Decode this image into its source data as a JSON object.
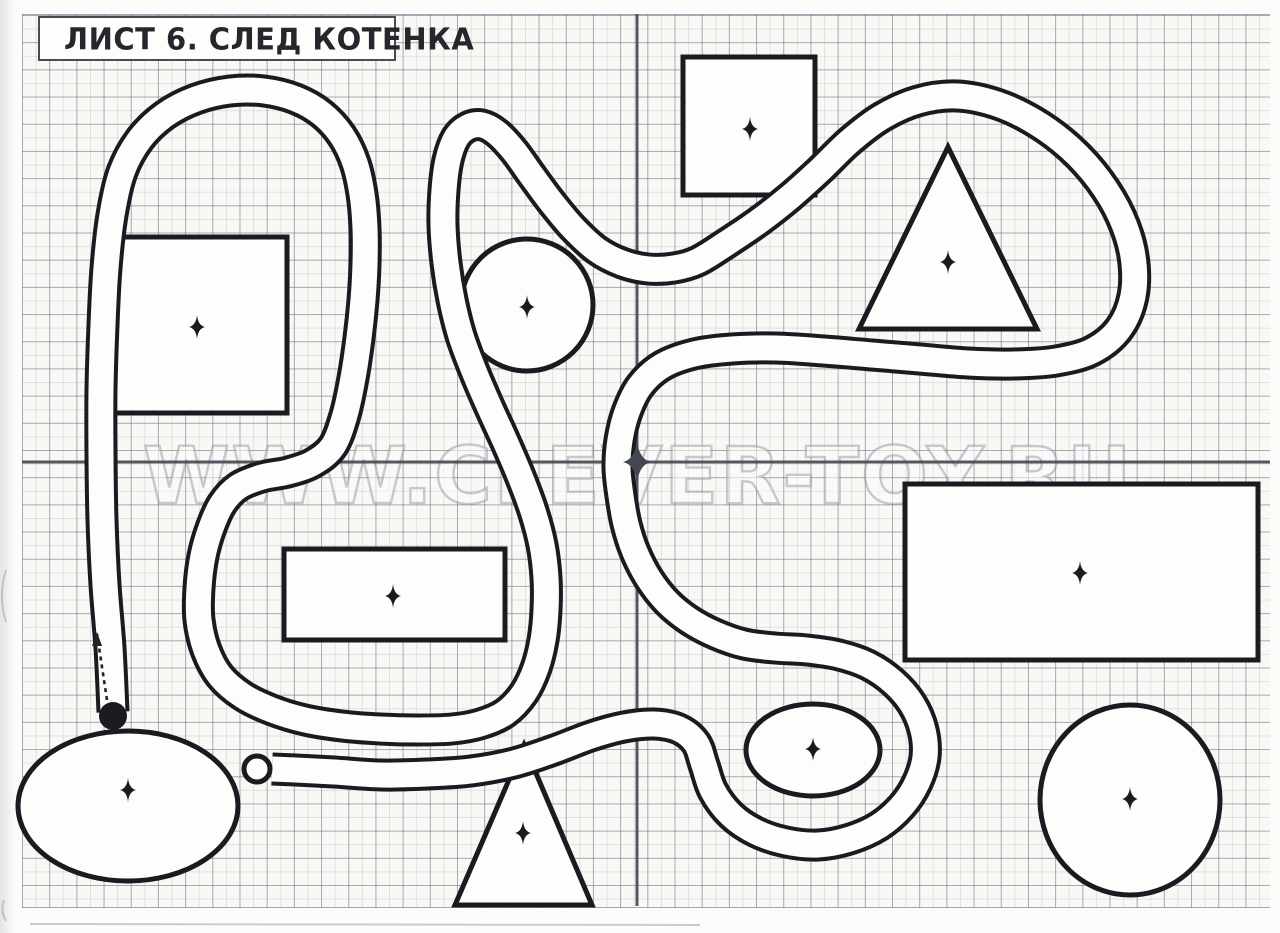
{
  "page": {
    "title": "ЛИСТ 6. СЛЕД КОТЕНКА",
    "watermark": "WWW.CLEVER-TOY.RU",
    "paper_color": "#f8f8f5",
    "ink_color": "#1a1b20",
    "grid_color": "#6e7387",
    "fold_line_color": "#444752",
    "scan_marks": [
      "M6,570 Q-2,596 6,622",
      "M4,900 Q0,911 6,921",
      "M30,924 L700,925"
    ]
  },
  "maze": {
    "fold": {
      "vertical_x": 637,
      "horizontal_y": 462,
      "top": 14,
      "bottom": 906,
      "left": 22,
      "right": 1270
    },
    "center_star": {
      "x": 637,
      "y": 462,
      "sx": 14,
      "sy": 22
    },
    "road": {
      "width_outer": 33,
      "width_inner": 25
    },
    "road_points": [
      [
        113,
        712
      ],
      [
        110,
        648
      ],
      [
        105,
        585
      ],
      [
        102,
        520
      ],
      [
        101,
        455
      ],
      [
        101,
        390
      ],
      [
        103,
        325
      ],
      [
        106,
        268
      ],
      [
        112,
        215
      ],
      [
        122,
        172
      ],
      [
        140,
        139
      ],
      [
        165,
        115
      ],
      [
        196,
        99
      ],
      [
        230,
        91
      ],
      [
        264,
        91
      ],
      [
        296,
        99
      ],
      [
        322,
        114
      ],
      [
        342,
        136
      ],
      [
        355,
        163
      ],
      [
        362,
        194
      ],
      [
        365,
        228
      ],
      [
        365,
        264
      ],
      [
        363,
        300
      ],
      [
        359,
        338
      ],
      [
        353,
        378
      ],
      [
        345,
        415
      ],
      [
        333,
        446
      ],
      [
        313,
        463
      ],
      [
        288,
        472
      ],
      [
        262,
        477
      ],
      [
        238,
        487
      ],
      [
        222,
        504
      ],
      [
        211,
        528
      ],
      [
        203,
        556
      ],
      [
        199,
        588
      ],
      [
        199,
        620
      ],
      [
        206,
        650
      ],
      [
        220,
        676
      ],
      [
        243,
        696
      ],
      [
        272,
        710
      ],
      [
        305,
        720
      ],
      [
        342,
        726
      ],
      [
        380,
        729
      ],
      [
        418,
        730
      ],
      [
        452,
        729
      ],
      [
        480,
        724
      ],
      [
        505,
        713
      ],
      [
        524,
        693
      ],
      [
        536,
        668
      ],
      [
        543,
        640
      ],
      [
        546,
        610
      ],
      [
        546,
        578
      ],
      [
        542,
        545
      ],
      [
        533,
        511
      ],
      [
        520,
        476
      ],
      [
        505,
        441
      ],
      [
        489,
        406
      ],
      [
        474,
        371
      ],
      [
        461,
        336
      ],
      [
        452,
        300
      ],
      [
        446,
        263
      ],
      [
        443,
        225
      ],
      [
        444,
        190
      ],
      [
        448,
        160
      ],
      [
        456,
        138
      ],
      [
        468,
        127
      ],
      [
        482,
        125
      ],
      [
        497,
        133
      ],
      [
        514,
        151
      ],
      [
        532,
        176
      ],
      [
        552,
        203
      ],
      [
        573,
        228
      ],
      [
        597,
        250
      ],
      [
        622,
        263
      ],
      [
        648,
        269
      ],
      [
        674,
        268
      ],
      [
        698,
        261
      ],
      [
        727,
        243
      ],
      [
        758,
        222
      ],
      [
        790,
        197
      ],
      [
        820,
        170
      ],
      [
        850,
        141
      ],
      [
        882,
        117
      ],
      [
        918,
        101
      ],
      [
        957,
        96
      ],
      [
        997,
        104
      ],
      [
        1035,
        122
      ],
      [
        1070,
        148
      ],
      [
        1099,
        180
      ],
      [
        1121,
        217
      ],
      [
        1133,
        256
      ],
      [
        1133,
        296
      ],
      [
        1119,
        329
      ],
      [
        1092,
        351
      ],
      [
        1056,
        361
      ],
      [
        1014,
        364
      ],
      [
        968,
        363
      ],
      [
        920,
        359
      ],
      [
        872,
        355
      ],
      [
        824,
        351
      ],
      [
        776,
        348
      ],
      [
        732,
        349
      ],
      [
        694,
        354
      ],
      [
        662,
        366
      ],
      [
        640,
        386
      ],
      [
        627,
        412
      ],
      [
        620,
        440
      ],
      [
        618,
        468
      ],
      [
        621,
        496
      ],
      [
        626,
        524
      ],
      [
        635,
        552
      ],
      [
        649,
        579
      ],
      [
        667,
        602
      ],
      [
        689,
        620
      ],
      [
        715,
        634
      ],
      [
        744,
        644
      ],
      [
        775,
        648
      ],
      [
        807,
        650
      ],
      [
        839,
        655
      ],
      [
        868,
        665
      ],
      [
        893,
        682
      ],
      [
        912,
        704
      ],
      [
        923,
        730
      ],
      [
        925,
        757
      ],
      [
        917,
        783
      ],
      [
        902,
        806
      ],
      [
        879,
        826
      ],
      [
        850,
        839
      ],
      [
        818,
        845
      ],
      [
        786,
        842
      ],
      [
        756,
        832
      ],
      [
        731,
        815
      ],
      [
        713,
        791
      ],
      [
        704,
        765
      ],
      [
        696,
        743
      ],
      [
        679,
        729
      ],
      [
        654,
        724
      ],
      [
        624,
        727
      ],
      [
        591,
        736
      ],
      [
        554,
        750
      ],
      [
        514,
        763
      ],
      [
        471,
        771
      ],
      [
        427,
        774
      ],
      [
        381,
        775
      ],
      [
        334,
        772
      ],
      [
        296,
        770
      ],
      [
        272,
        769
      ]
    ],
    "start_marker": {
      "x": 113,
      "y": 716,
      "r": 14
    },
    "end_marker": {
      "x": 257,
      "y": 769,
      "r": 13
    },
    "arrow": {
      "x1": 107,
      "y1": 700,
      "x2": 97,
      "y2": 634
    },
    "shapes": [
      {
        "name": "square-top-left",
        "type": "rect",
        "x": 107,
        "y": 237,
        "w": 180,
        "h": 176,
        "star": [
          197,
          327
        ]
      },
      {
        "name": "circle-upper-middle",
        "type": "ellipse",
        "cx": 527,
        "cy": 305,
        "rx": 66,
        "ry": 66,
        "star": [
          527,
          307
        ]
      },
      {
        "name": "square-top-middle",
        "type": "rect",
        "x": 683,
        "y": 57,
        "w": 132,
        "h": 138,
        "star": [
          750,
          129
        ]
      },
      {
        "name": "triangle-top-right",
        "type": "triangle",
        "pts": [
          [
            948,
            147
          ],
          [
            859,
            329
          ],
          [
            1037,
            329
          ]
        ],
        "star": [
          948,
          262
        ]
      },
      {
        "name": "rectangle-right",
        "type": "rect",
        "x": 905,
        "y": 484,
        "w": 353,
        "h": 176,
        "star": [
          1080,
          573
        ]
      },
      {
        "name": "rectangle-middle",
        "type": "rect",
        "x": 284,
        "y": 549,
        "w": 221,
        "h": 91,
        "star": [
          393,
          596
        ]
      },
      {
        "name": "ellipse-small",
        "type": "ellipse",
        "cx": 813,
        "cy": 750,
        "rx": 67,
        "ry": 46,
        "star": [
          813,
          749
        ]
      },
      {
        "name": "circle-bottom-right",
        "type": "ellipse",
        "cx": 1130,
        "cy": 800,
        "rx": 90,
        "ry": 95,
        "star": [
          1130,
          799
        ]
      },
      {
        "name": "triangle-bottom",
        "type": "triangle",
        "pts": [
          [
            524,
            745
          ],
          [
            455,
            905
          ],
          [
            592,
            905
          ]
        ],
        "star": [
          523,
          833
        ]
      },
      {
        "name": "ellipse-bottom-left",
        "type": "ellipse",
        "cx": 128,
        "cy": 806,
        "rx": 110,
        "ry": 75,
        "star": [
          128,
          790
        ]
      }
    ]
  }
}
